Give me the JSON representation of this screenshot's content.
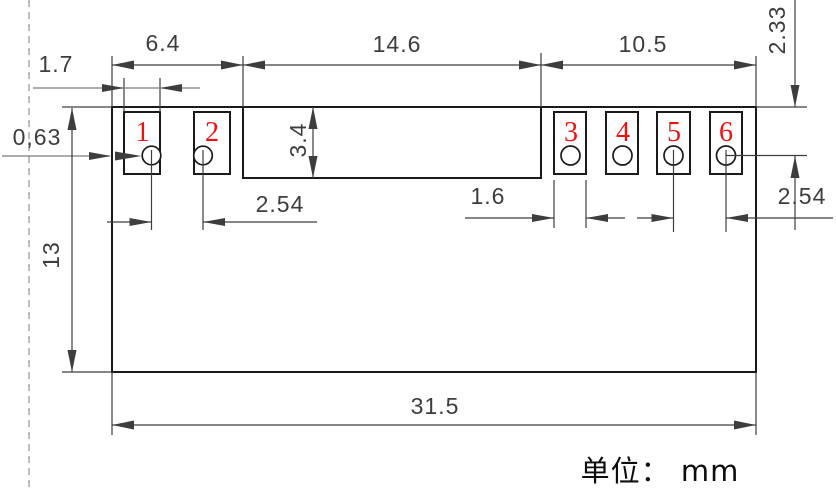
{
  "drawing": {
    "type": "component-footprint-dimension-drawing",
    "unit_note": "单位： mm",
    "pads": [
      {
        "number": "1"
      },
      {
        "number": "2"
      },
      {
        "number": "3"
      },
      {
        "number": "4"
      },
      {
        "number": "5"
      },
      {
        "number": "6"
      }
    ],
    "dimensions": {
      "pads_left_span": "6.4",
      "middle_span": "14.6",
      "pads_right_span": "10.5",
      "pad_width_left": "1.7",
      "hole_edge_offset": "0,63",
      "notch_height": "3.4",
      "pitch_left": "2.54",
      "pad_width_right": "1.6",
      "pitch_right": "2.54",
      "hole_offset_right": "2.33",
      "body_height": "13",
      "body_width": "31.5"
    },
    "colors": {
      "outline": "#1a1a1a",
      "dimension": "#3d3d3d",
      "light_dimension": "#7a7a7a",
      "pad_number": "#ee1111",
      "dashed_line": "#a8a8a8"
    }
  }
}
